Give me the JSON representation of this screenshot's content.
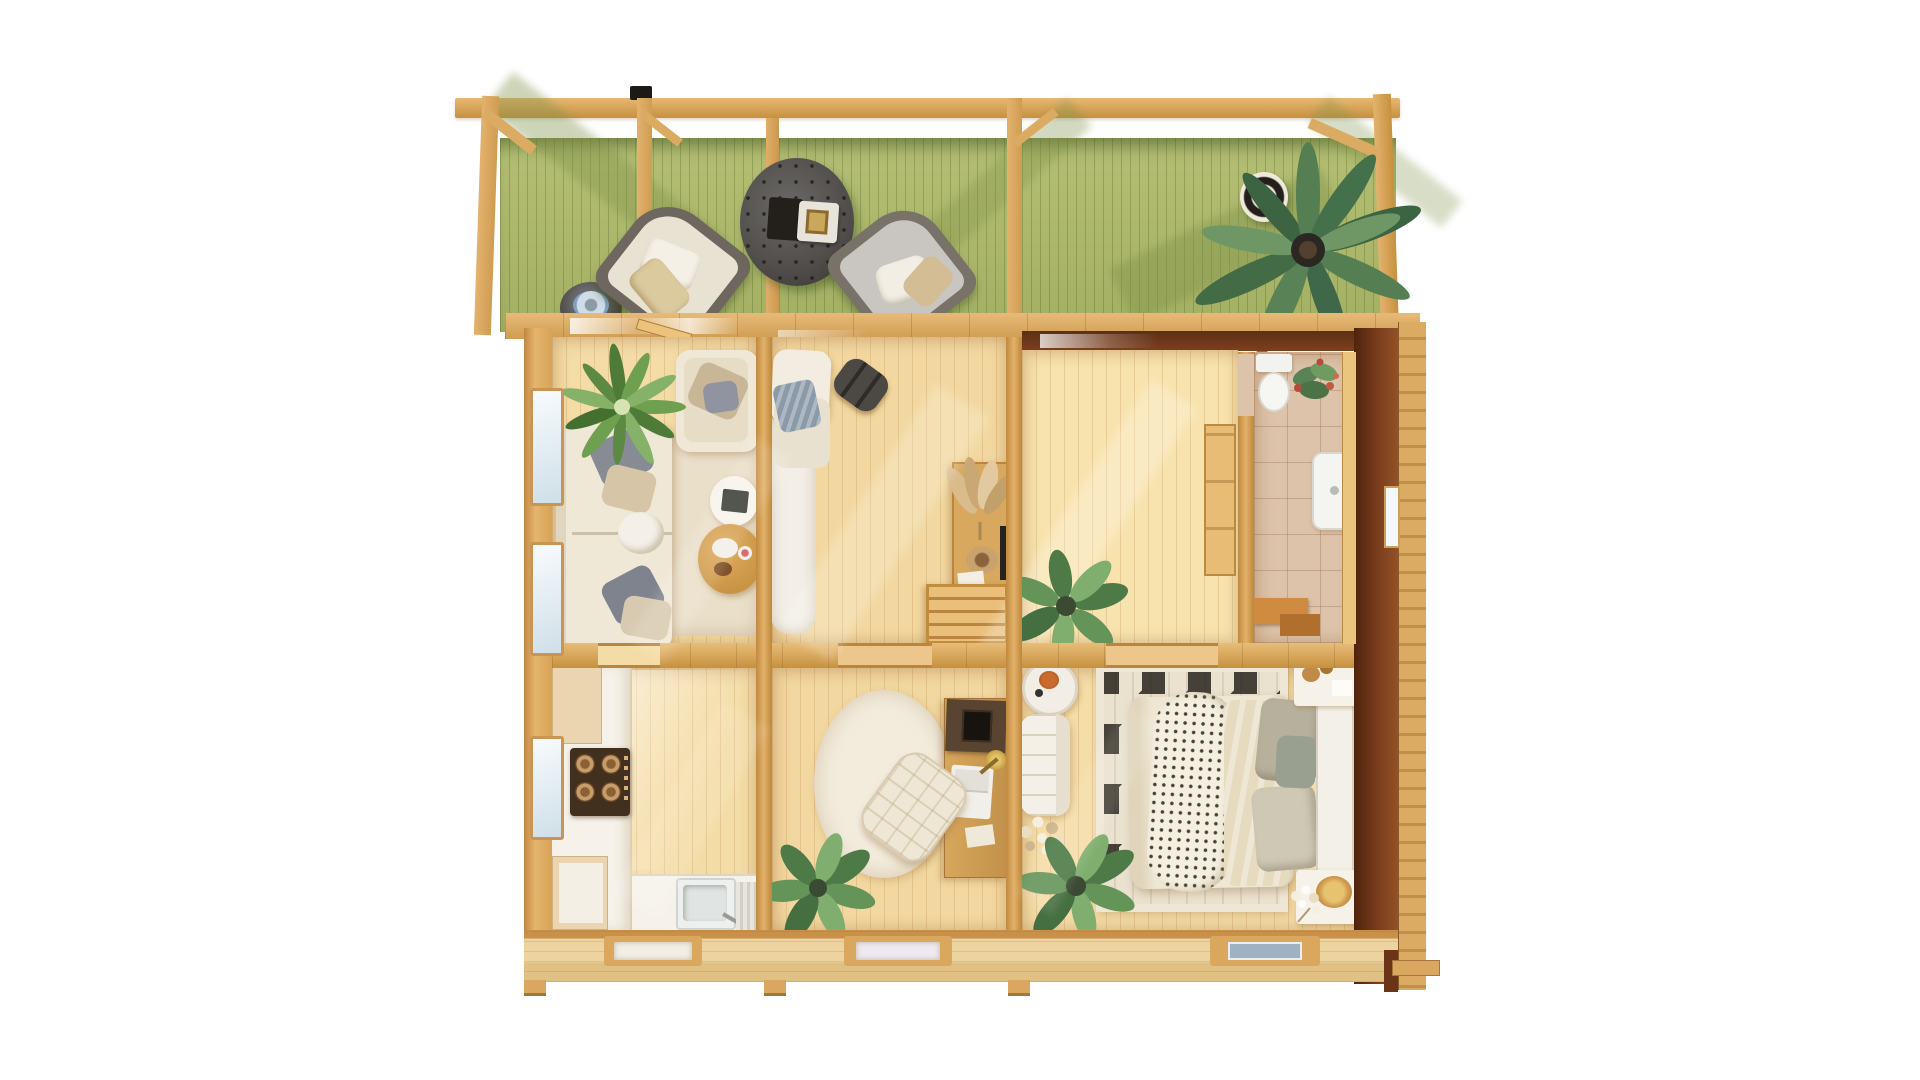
{
  "scene": {
    "description": "Top-down 3D render of a wooden log cabin floor plan with front pergola terrace",
    "terrace": {
      "name": "pergola terrace",
      "objects": [
        "pergola-beam",
        "pergola-posts",
        "green-deck",
        "dark-side-table",
        "lounge-chair-left",
        "tufted-ottoman-table",
        "lounge-chair-right",
        "striped-basket",
        "palm-plant"
      ]
    },
    "rooms": [
      {
        "name": "living-room",
        "objects": [
          "corner-sofa",
          "armchair",
          "pillows",
          "agave-plant",
          "area-rug",
          "white-side-table",
          "wood-coffee-table",
          "windows"
        ]
      },
      {
        "name": "hallway-room",
        "objects": [
          "chaise-lounge",
          "blue-blanket",
          "shag-runner-rug",
          "duffel-bag",
          "console-table",
          "pampas-grass",
          "decor-bowl",
          "wall-screen",
          "wooden-stairs"
        ]
      },
      {
        "name": "large-room",
        "objects": [
          "potted-plant",
          "door-panel",
          "sunlight-streak",
          "doorway-sill"
        ]
      },
      {
        "name": "bathroom",
        "objects": [
          "tile-floor",
          "toilet",
          "flower-plant",
          "shower-tray",
          "wooden-bench",
          "window"
        ]
      },
      {
        "name": "kitchen",
        "objects": [
          "white-counter-run",
          "upper-cabinet",
          "cooktop-4-burners",
          "lower-cabinet",
          "sink",
          "drainboard",
          "window",
          "entry-mat"
        ]
      },
      {
        "name": "office",
        "objects": [
          "round-rug",
          "desk",
          "storage-box",
          "laptop",
          "desk-lamp",
          "tufted-chair",
          "potted-plant",
          "entry-mat"
        ]
      },
      {
        "name": "bedroom",
        "objects": [
          "geometric-rug",
          "double-bed",
          "dotted-throw",
          "duvet",
          "pillows",
          "headboard",
          "nightstand-top",
          "nightstand-bottom",
          "round-side-table",
          "lounge-chair",
          "dried-flowers",
          "potted-plant",
          "blue-entry-mat"
        ]
      }
    ],
    "palette": {
      "deck_green": "#aeb96d",
      "deck_shadow": "#7f9148",
      "pergola_wood": "#dcab66",
      "wall_wood_dark": "#c6913f",
      "floor_wood": "#f4dca6",
      "dark_side_wall": "#7c3f1d",
      "tile_beige": "#dcc3aa",
      "counter_white": "#f6f2e9",
      "sofa_cream": "#f0e8d6",
      "charcoal": "#55524f",
      "plant_green": "#5a8257",
      "blanket_blue": "#8b9aa9",
      "mat_blue": "#9fb2c2",
      "accent_orange": "#c96a2f"
    }
  }
}
